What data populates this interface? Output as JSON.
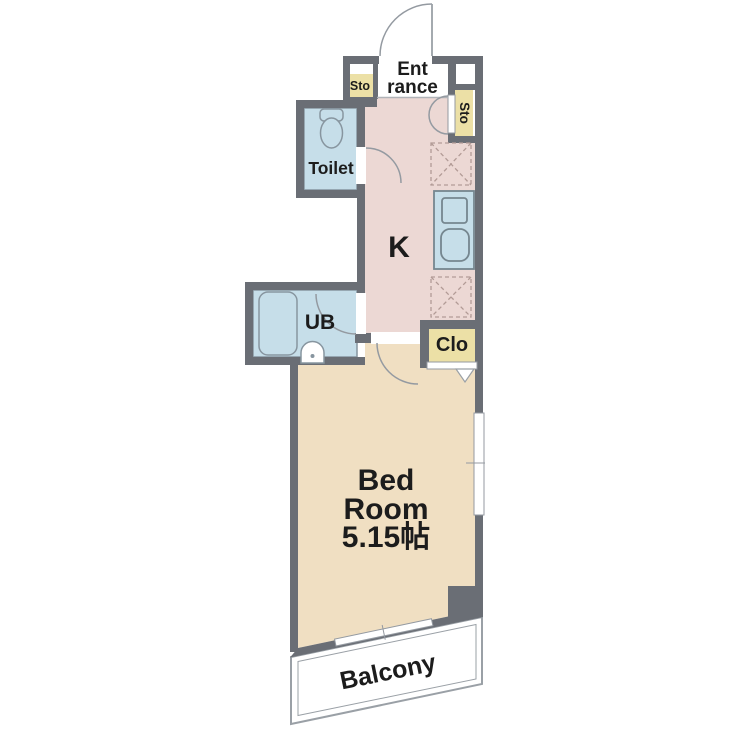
{
  "floorplan": {
    "labels": {
      "entrance_line1": "Ent",
      "entrance_line2": "rance",
      "storage_left": "Sto",
      "storage_right": "Sto",
      "toilet": "Toilet",
      "kitchen": "K",
      "unit_bath": "UB",
      "closet": "Clo",
      "bedroom_line1": "Bed",
      "bedroom_line2": "Room",
      "bedroom_size": "5.15帖",
      "balcony": "Balcony"
    },
    "colors": {
      "wall": "#6a6e75",
      "kitchen_floor": "#ecd8d4",
      "bedroom_floor": "#f0dfc2",
      "wet_area": "#c6dee9",
      "wet_area_edge": "#87959f",
      "counter_edge": "#75868f",
      "storage": "#ece0a6",
      "line": "#949aa1",
      "dash": "#b29b96"
    }
  }
}
